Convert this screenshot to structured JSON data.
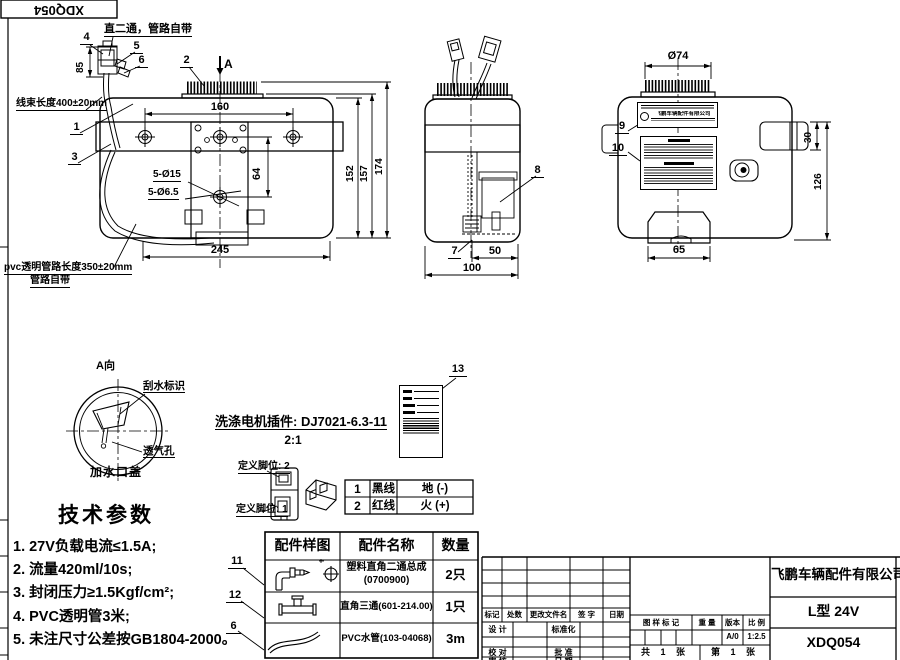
{
  "sheet": {
    "corner_code": "XDQ054"
  },
  "front_view": {
    "callouts": {
      "c1": "1",
      "c2": "2",
      "c3": "3",
      "c4": "4",
      "c5": "5",
      "c6": "6"
    },
    "section_label": "A",
    "note_fitting": "直二通，管路自带",
    "note_harness": "线束长度400±20mm",
    "note_pvc_line1": "pvc透明管路长度350±20mm",
    "note_pvc_line2": "管路自带",
    "dims": {
      "d160": "160",
      "d64": "64",
      "d245": "245",
      "d152": "152",
      "d157": "157",
      "d174": "174",
      "d85": "85",
      "holes_large": "5-Ø15",
      "holes_small": "5-Ø6.5"
    }
  },
  "side_view": {
    "callouts": {
      "c7": "7",
      "c8": "8"
    },
    "dims": {
      "d50": "50",
      "d100": "100"
    }
  },
  "back_view": {
    "callouts": {
      "c9": "9",
      "c10": "10"
    },
    "dims": {
      "cap_dia": "Ø74",
      "d30": "30",
      "d126": "126",
      "d65": "65"
    },
    "nameplate_company": "飞鹏车辆配件有限公司"
  },
  "cap_detail": {
    "view_label": "A向",
    "wiper_label": "刮水标识",
    "vent_label": "透气孔",
    "caption": "加水口盖"
  },
  "connector_detail": {
    "title": "洗涤电机插件: DJ7021-6.3-11",
    "scale": "2:1",
    "pin2_label": "定义脚位: 2",
    "pin1_label": "定义脚位: 1",
    "pin_table": [
      {
        "no": "1",
        "wire": "黑线",
        "func": "地 (-)"
      },
      {
        "no": "2",
        "wire": "红线",
        "func": "火 (+)"
      }
    ]
  },
  "sticker": {
    "callout": "13"
  },
  "tech_params": {
    "title": "技术参数",
    "items": [
      "1. 27V负载电流≤1.5A;",
      "2. 流量420ml/10s;",
      "3. 封闭压力≥1.5Kgf/cm²;",
      "4. PVC透明管3米;",
      "5. 未注尺寸公差按GB1804-2000。"
    ]
  },
  "parts_table": {
    "headers": [
      "配件样图",
      "配件名称",
      "数量"
    ],
    "rows": [
      {
        "callout": "11",
        "name": "塑料直角二通总成",
        "code": "(0700900)",
        "qty": "2只"
      },
      {
        "callout": "12",
        "name": "直角三通(601-214.00)",
        "qty": "1只"
      },
      {
        "callout": "6",
        "name": "PVC水管(103-04068)",
        "qty": "3m"
      }
    ]
  },
  "title_block": {
    "company": "飞鹏车辆配件有限公司",
    "product": "L型 24V",
    "drawing_no": "XDQ054",
    "rev_headers": [
      "标记",
      "处数",
      "更改文件名",
      "签 字",
      "日期"
    ],
    "roles": {
      "design": "设 计",
      "standardize": "标准化",
      "check": "校 对",
      "approve": "批 准",
      "review": "审 核",
      "date": "日 期"
    },
    "stamp": {
      "mark": "图 样 标 记",
      "weight": "重 量",
      "version_label": "版本",
      "scale_label": "比 例",
      "version": "A/0",
      "scale": "1:2.5",
      "sheet_total": "共 1 张",
      "sheet_no": "第 1 张"
    }
  }
}
